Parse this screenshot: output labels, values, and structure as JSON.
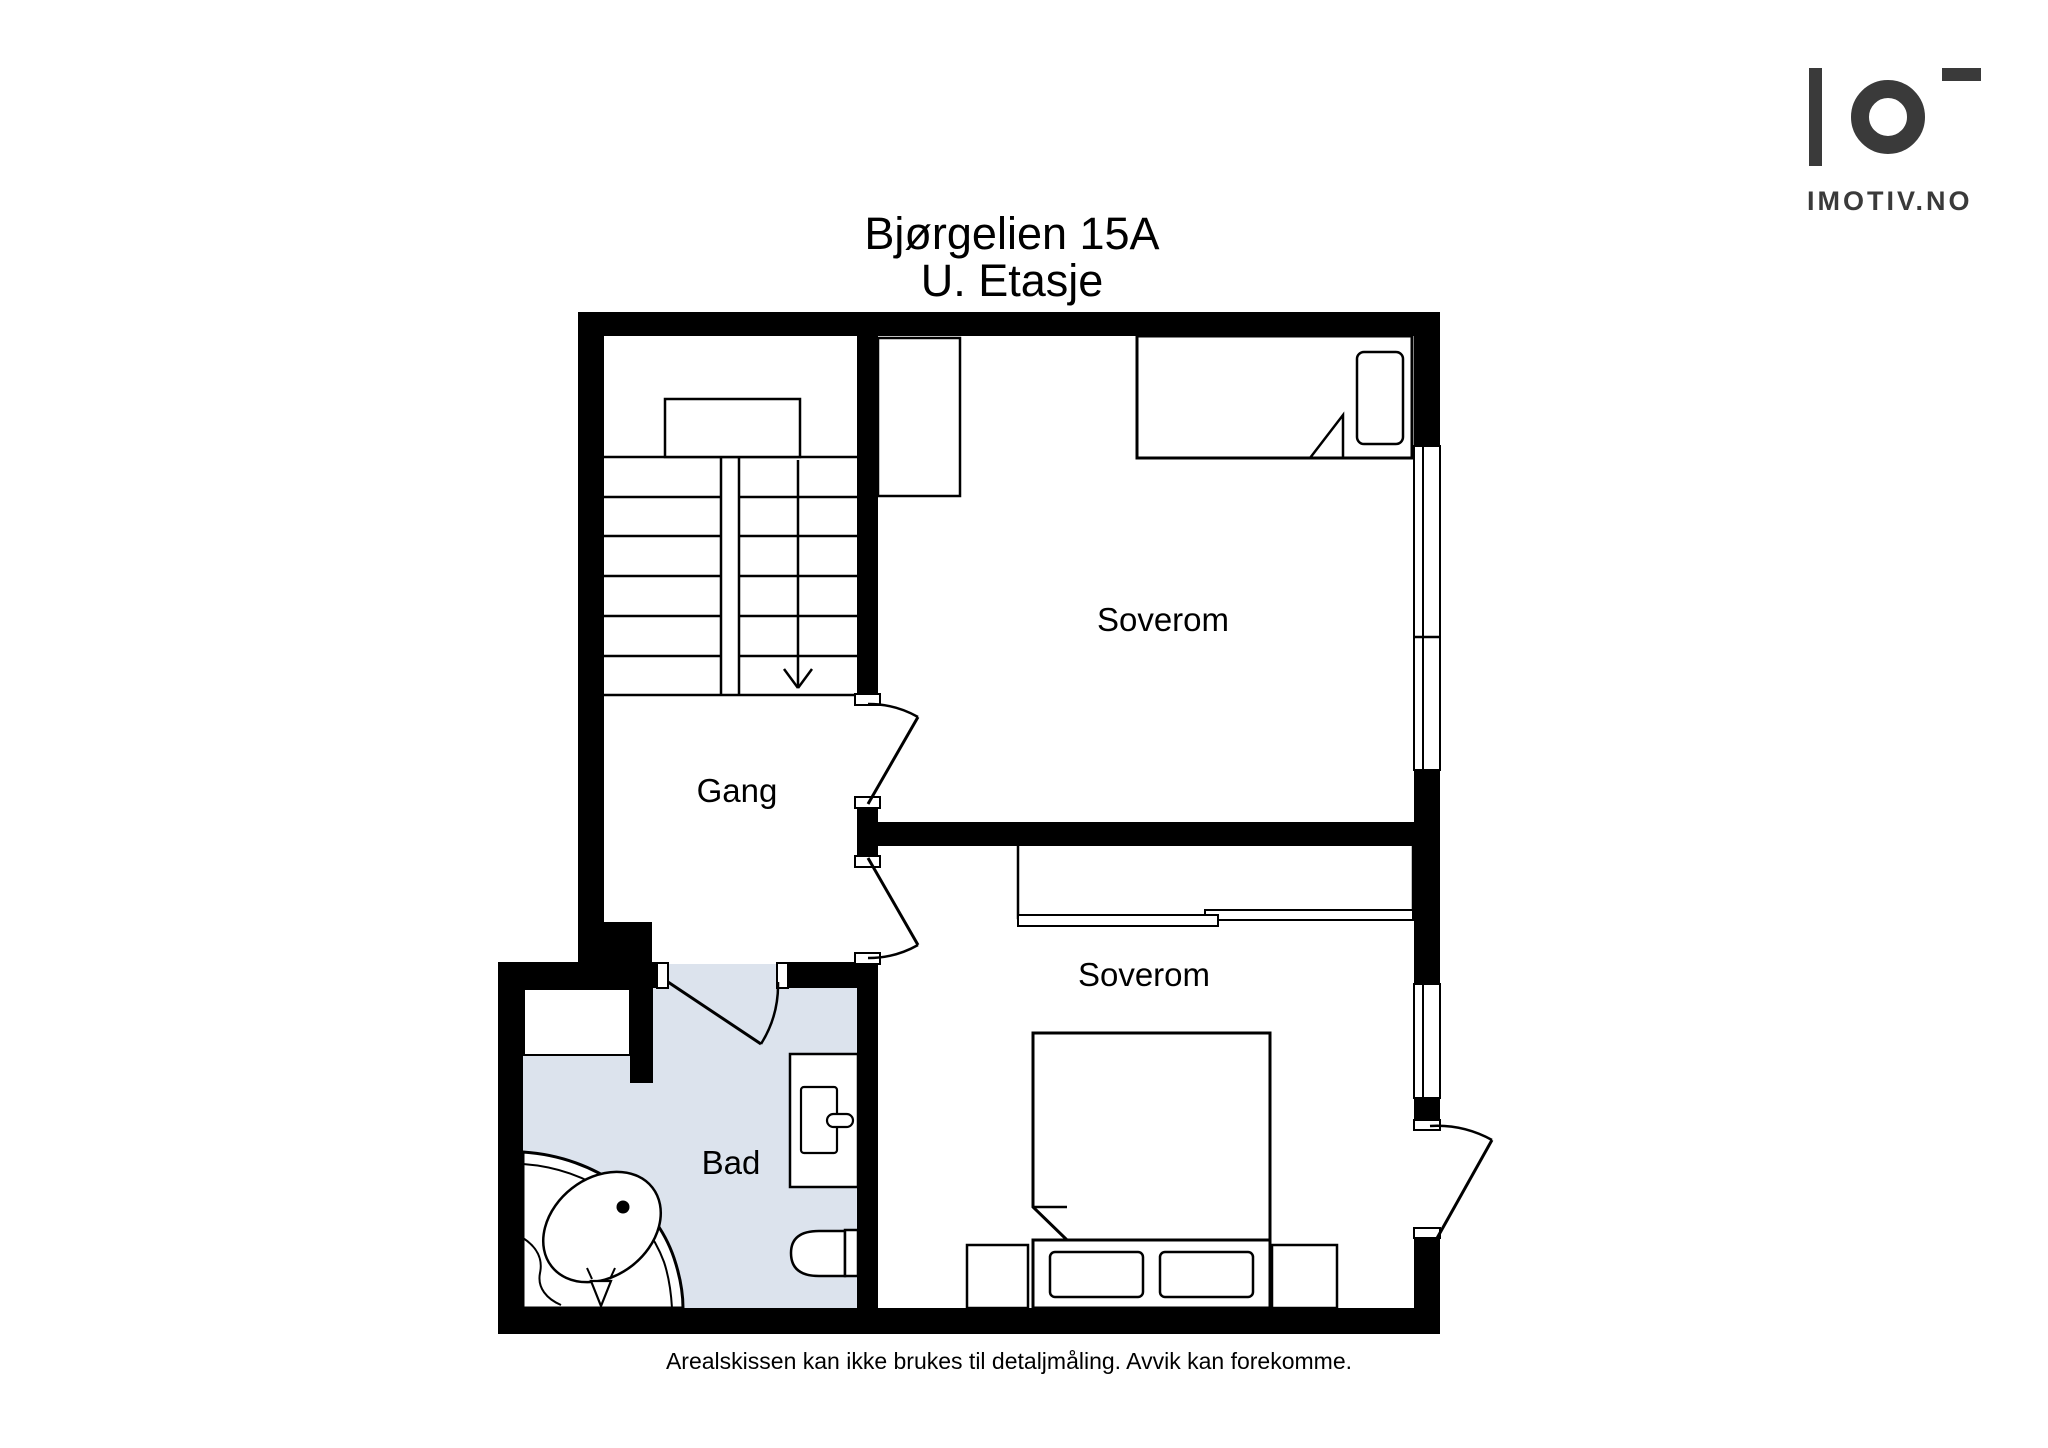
{
  "title": {
    "line1": "Bjørgelien 15A",
    "line2": "U. Etasje"
  },
  "logo": {
    "brand": "IMOTIV.NO"
  },
  "rooms": {
    "soverom_top": "Soverom",
    "gang": "Gang",
    "soverom_bottom": "Soverom",
    "bad": "Bad"
  },
  "footer": {
    "disclaimer": "Arealskissen kan ikke brukes til detaljmåling. Avvik kan forekomme."
  },
  "colors": {
    "wall": "#000000",
    "bath_floor": "#dce3ed",
    "line": "#000000",
    "logo": "#3a3a3a"
  }
}
